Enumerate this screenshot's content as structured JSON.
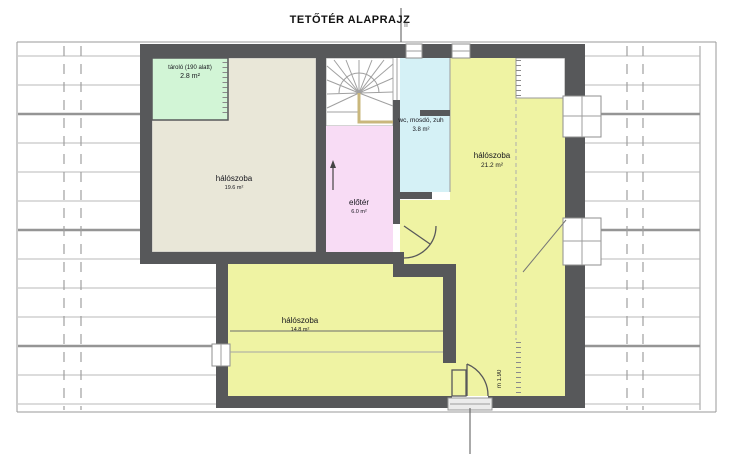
{
  "title": "TETŐTÉR ALAPRAJZ",
  "rooms": [
    {
      "name": "tároló (190 alatt)",
      "area": "2.8 m²"
    },
    {
      "name": "hálószoba",
      "area": "19.6 m²"
    },
    {
      "name": "előtér",
      "area": "6.0 m²"
    },
    {
      "name": "wc, mosdó, zuh",
      "area": "3.8 m²"
    },
    {
      "name": "hálószoba",
      "area": "21.2 m²"
    },
    {
      "name": "hálószoba",
      "area": "14.8 m²"
    }
  ],
  "annotations": {
    "height_marker": "m 1.90",
    "section_mark": "II"
  },
  "colors": {
    "wall": "#57585a",
    "storage": "#d2f5d6",
    "bedroom_nw": "#e9e7d8",
    "hall": "#f8dcf5",
    "bath": "#d5f1f6",
    "bedroom": "#eff3a3"
  }
}
